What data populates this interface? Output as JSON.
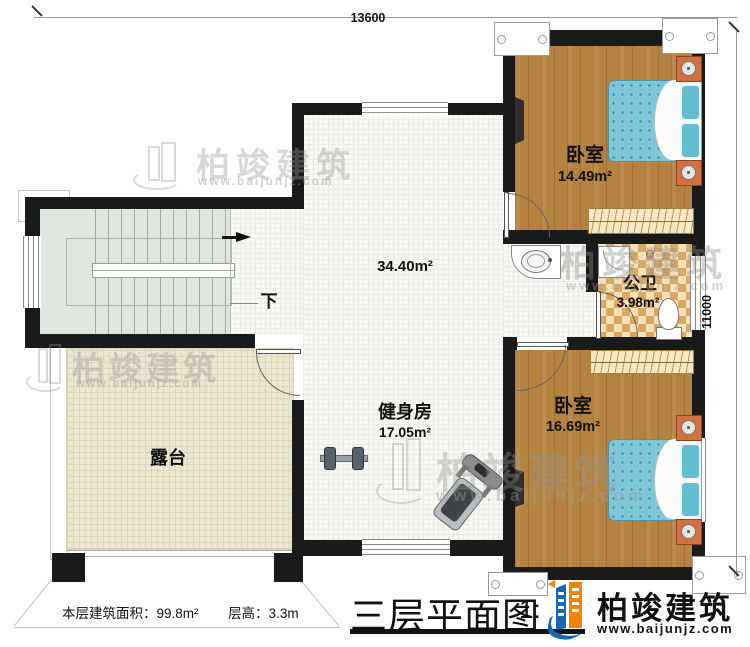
{
  "plan": {
    "title": "三层平面图",
    "scale_prefix": "1:",
    "note_area": "本层建筑面积：99.8m²",
    "note_height": "层高：3.3m",
    "dim_top": "13600",
    "dim_right": "11000"
  },
  "rooms": {
    "bedroom_top": {
      "name": "卧室",
      "area": "14.49m²"
    },
    "bathroom": {
      "name": "公卫",
      "area": "3.98m²"
    },
    "bedroom_bottom": {
      "name": "卧室",
      "area": "16.69m²"
    },
    "gym": {
      "name": "健身房",
      "area": "17.05m²"
    },
    "hall": {
      "area": "34.40m²"
    },
    "terrace": {
      "name": "露台"
    },
    "stair": {
      "direction": "下"
    }
  },
  "brand": {
    "name": "柏竣建筑",
    "url": "www.baijunjz.com"
  },
  "watermark": {
    "name": "柏竣建筑",
    "url": "www.baijunjz.com"
  },
  "colors": {
    "wall": "#1a1a1a",
    "wood_floor": "#b5833f",
    "mattress_blue": "#7ec6d8",
    "bath_tile_light": "#f2e2b8",
    "bath_tile_dark": "#dca760",
    "terrace_floor": "#ece7d2",
    "stair_floor": "#dfe6df",
    "nightstand": "#d4703c",
    "brand_blue": "#1668b3",
    "brand_orange": "#f08300"
  }
}
